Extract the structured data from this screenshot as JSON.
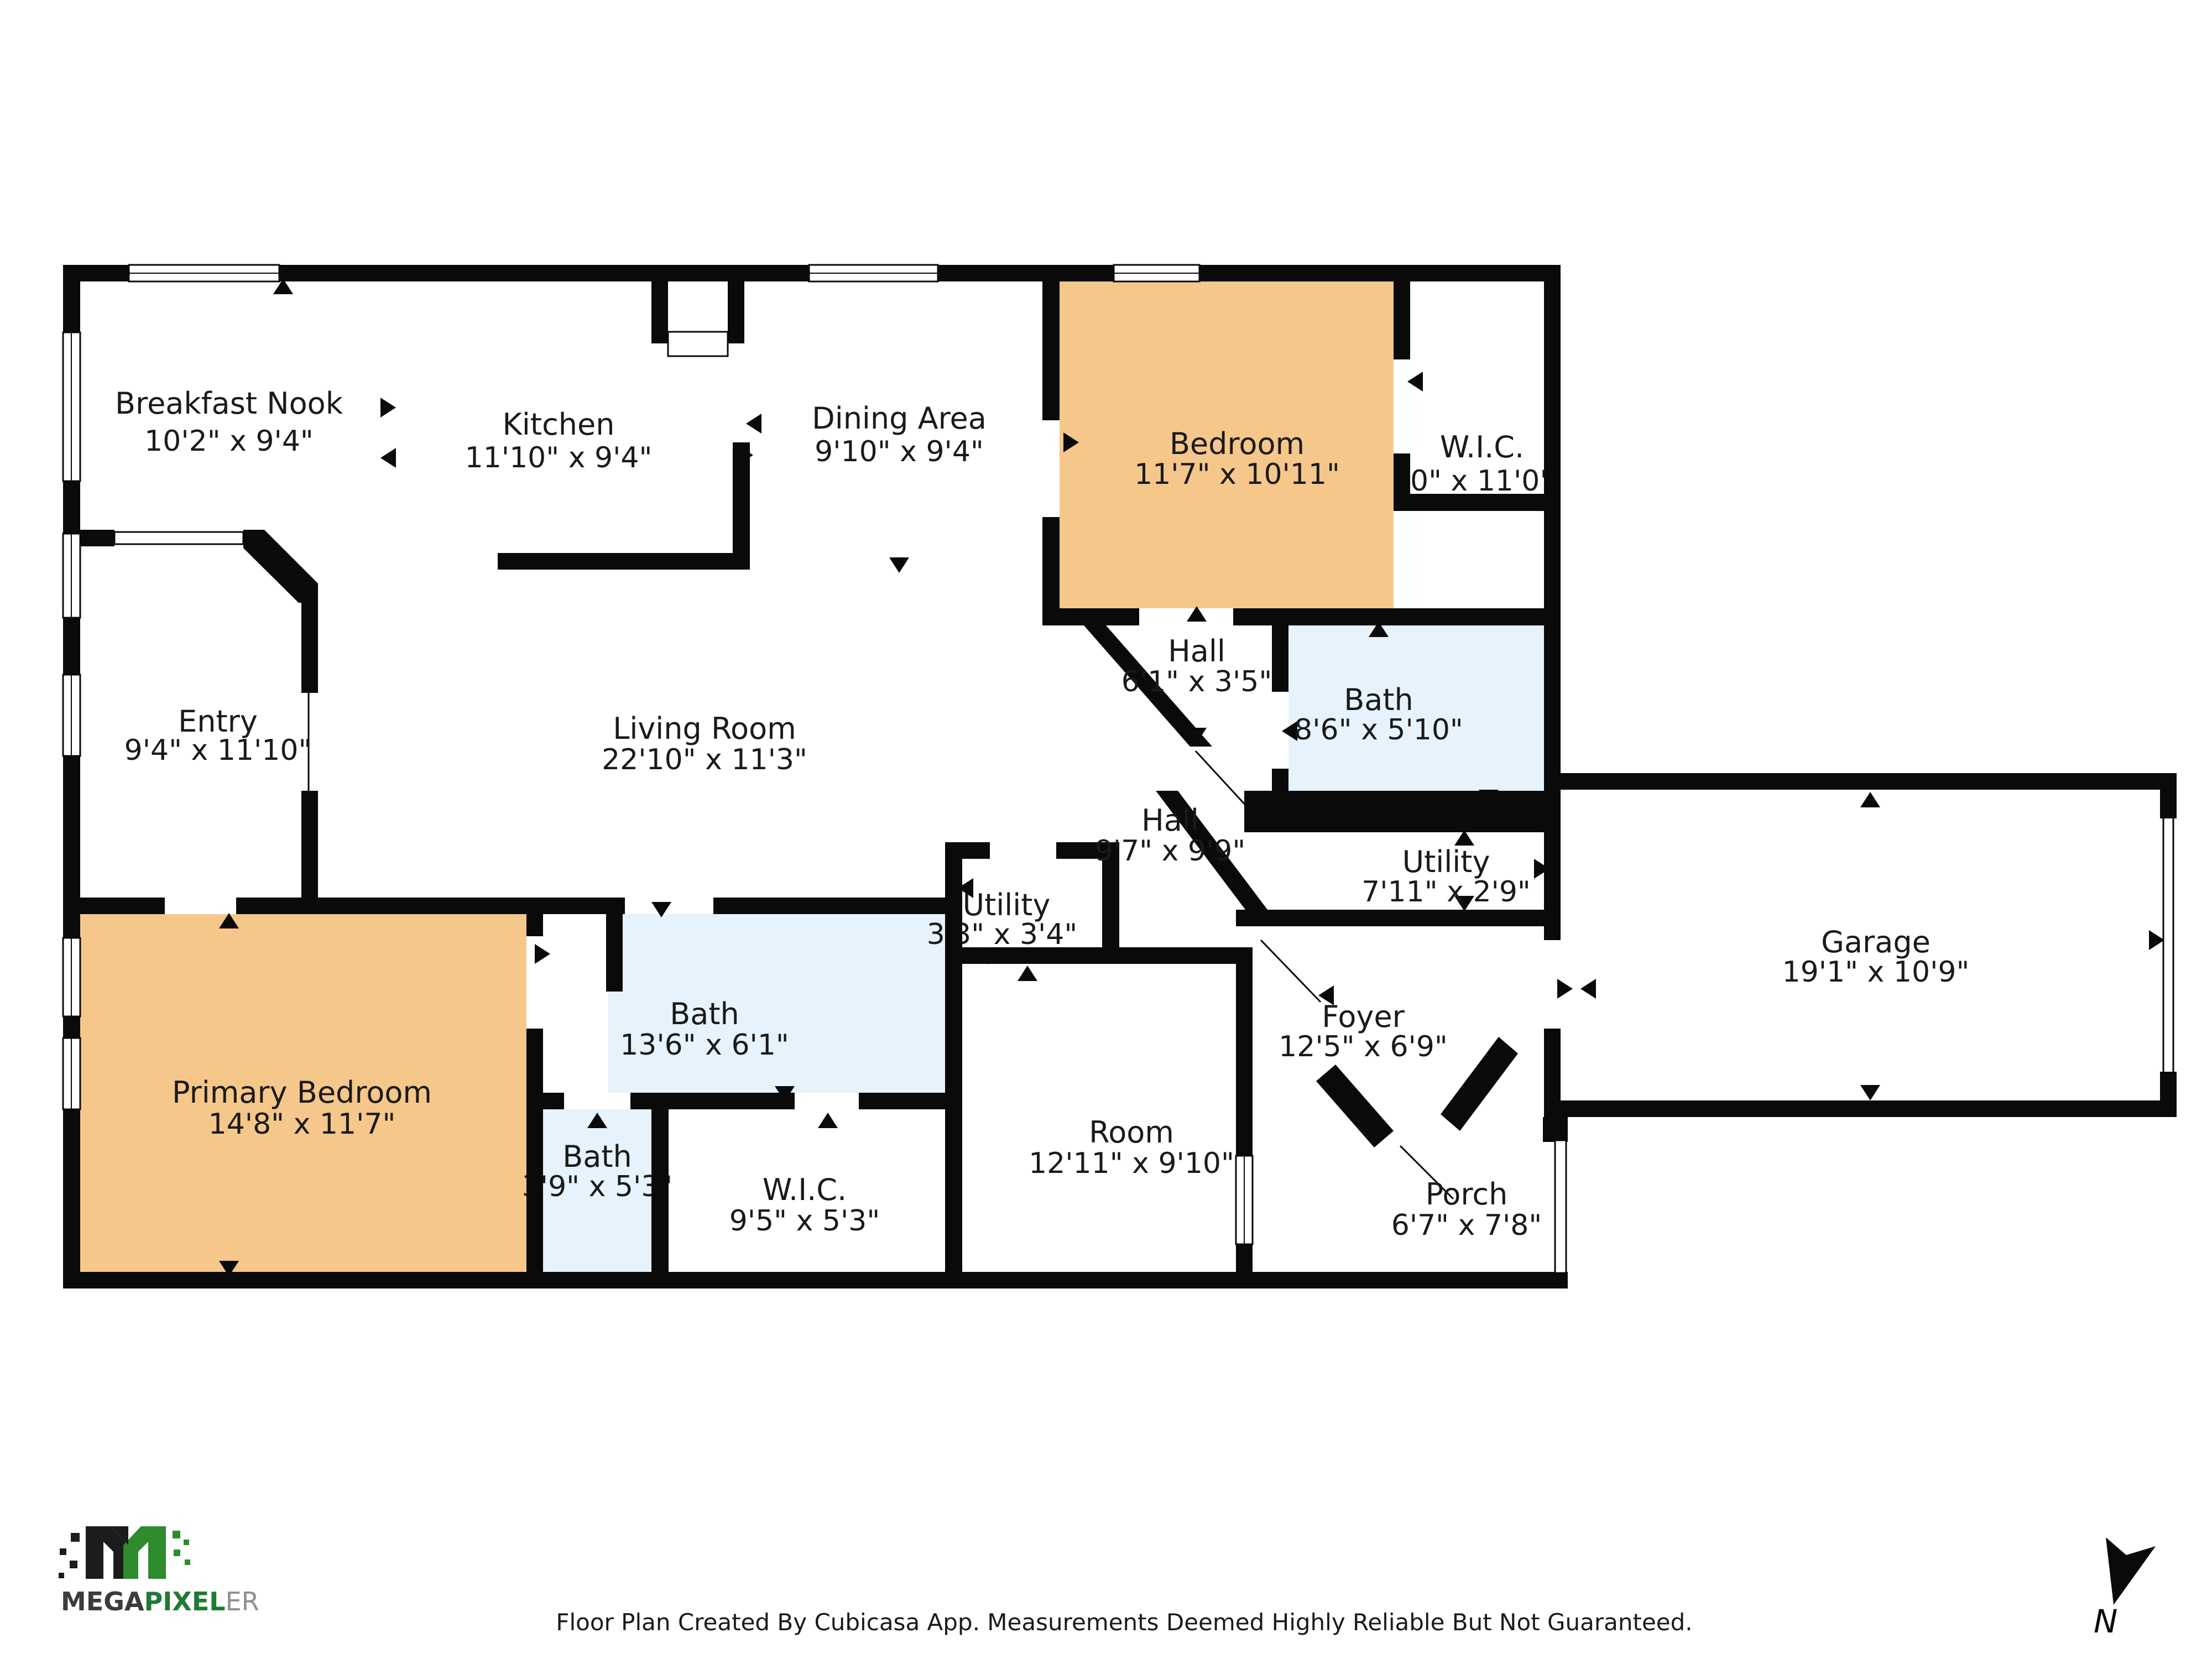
{
  "rooms": {
    "breakfast_nook": {
      "name": "Breakfast Nook",
      "dims": "10'2\" x 9'4\""
    },
    "kitchen": {
      "name": "Kitchen",
      "dims": "11'10\" x 9'4\""
    },
    "dining_area": {
      "name": "Dining Area",
      "dims": "9'10\" x 9'4\""
    },
    "bedroom": {
      "name": "Bedroom",
      "dims": "11'7\" x 10'11\""
    },
    "wic_top": {
      "name": "W.I.C.",
      "dims": "'0\" x 11'0\""
    },
    "entry": {
      "name": "Entry",
      "dims": "9'4\" x 11'10\""
    },
    "living_room": {
      "name": "Living Room",
      "dims": "22'10\" x 11'3\""
    },
    "hall_small": {
      "name": "Hall",
      "dims": "6'1\" x 3'5\""
    },
    "bath_upper": {
      "name": "Bath",
      "dims": "8'6\" x 5'10\""
    },
    "hall_main": {
      "name": "Hall",
      "dims": "9'7\" x 9'9\""
    },
    "utility_right": {
      "name": "Utility",
      "dims": "7'11\" x 2'9\""
    },
    "utility_small": {
      "name": "Utility",
      "dims": "3'3\" x 3'4\""
    },
    "garage": {
      "name": "Garage",
      "dims": "19'1\" x 10'9\""
    },
    "foyer": {
      "name": "Foyer",
      "dims": "12'5\" x 6'9\""
    },
    "primary_bedroom": {
      "name": "Primary Bedroom",
      "dims": "14'8\" x 11'7\""
    },
    "bath_main": {
      "name": "Bath",
      "dims": "13'6\" x 6'1\""
    },
    "bath_small": {
      "name": "Bath",
      "dims": "3'9\" x 5'3\""
    },
    "wic_bottom": {
      "name": "W.I.C.",
      "dims": "9'5\" x 5'3\""
    },
    "room": {
      "name": "Room",
      "dims": "12'11\" x 9'10\""
    },
    "porch": {
      "name": "Porch",
      "dims": "6'7\" x 7'8\""
    }
  },
  "colors": {
    "wall": "#0a0a0a",
    "bedroom_fill": "#f5c78a",
    "bath_fill": "#e6f2fc",
    "logo_green": "#1f7a33",
    "logo_dark": "#3b3b3b",
    "logo_gray": "#8f8f8f"
  },
  "logo": {
    "mega": "MEGA",
    "pixel": "PIXEL",
    "er": "ER"
  },
  "compass": {
    "label": "N"
  },
  "footer": "Floor Plan Created By Cubicasa App. Measurements Deemed Highly Reliable But Not Guaranteed."
}
